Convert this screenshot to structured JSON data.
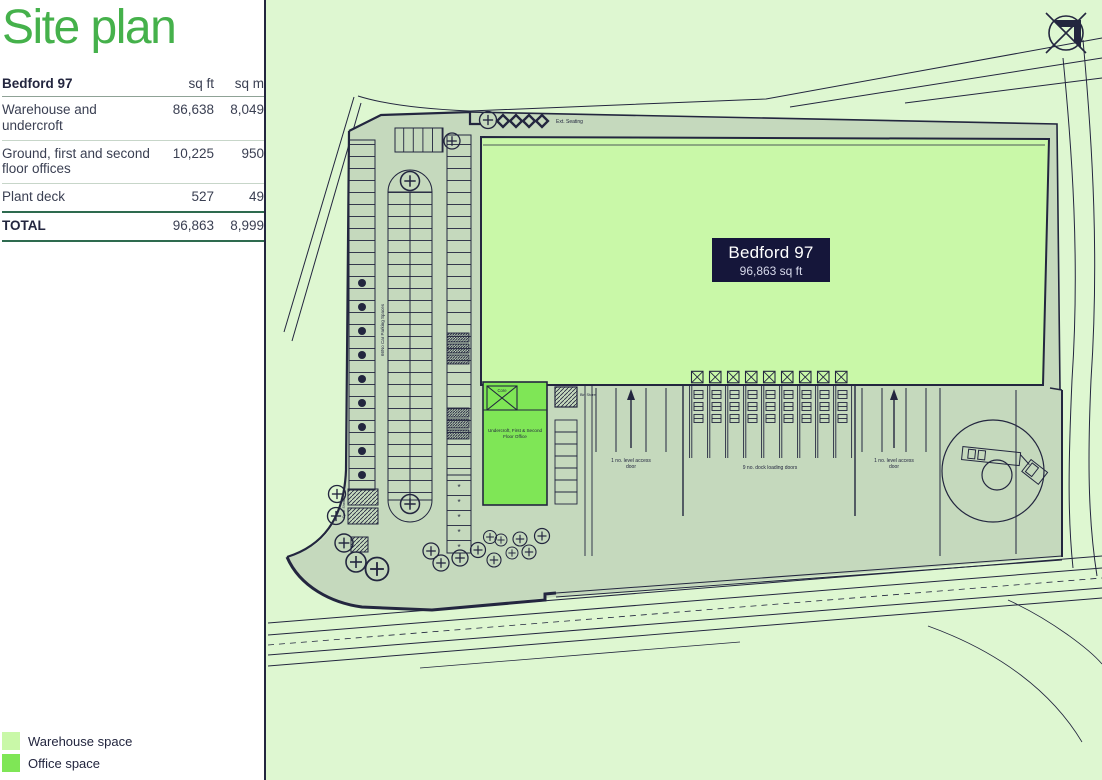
{
  "sidebar": {
    "title": "Site plan",
    "table": {
      "name": "Bedford 97",
      "unit_cols": [
        "sq ft",
        "sq m"
      ],
      "rows": [
        {
          "label": "Warehouse and undercroft",
          "sqft": "86,638",
          "sqm": "8,049"
        },
        {
          "label": "Ground, first and second floor offices",
          "sqft": "10,225",
          "sqm": "950"
        },
        {
          "label": "Plant deck",
          "sqft": "527",
          "sqm": "49"
        }
      ],
      "total": {
        "label": "TOTAL",
        "sqft": "96,863",
        "sqm": "8,999"
      }
    },
    "legend": [
      {
        "label": "Warehouse space",
        "color": "#c9f8a8"
      },
      {
        "label": "Office space",
        "color": "#7fe656"
      }
    ]
  },
  "plan": {
    "building": {
      "name": "Bedford 97",
      "area": "96,863 sq ft"
    },
    "labels": {
      "ext_seating": "Ext. Seating",
      "core": "Core",
      "bin_store": "Bin Store",
      "office": "Undercroft, First & Second Floor Office",
      "parking_count": "66No Car Parking Spaces",
      "cycle_shelters": "Cycle Shelters",
      "access_left": "1 no. level access door",
      "dock": "9 no. dock loading doors",
      "access_right": "1 no. level access door",
      "accessible_marker": "*"
    }
  },
  "colors": {
    "title_green": "#45b14b",
    "page_bg": "#def7d1",
    "warehouse_fill": "#c9f8a8",
    "office_fill": "#7fe656",
    "yard_fill": "#c5d9bd",
    "line": "#23263f",
    "label_bg": "#15163a"
  }
}
